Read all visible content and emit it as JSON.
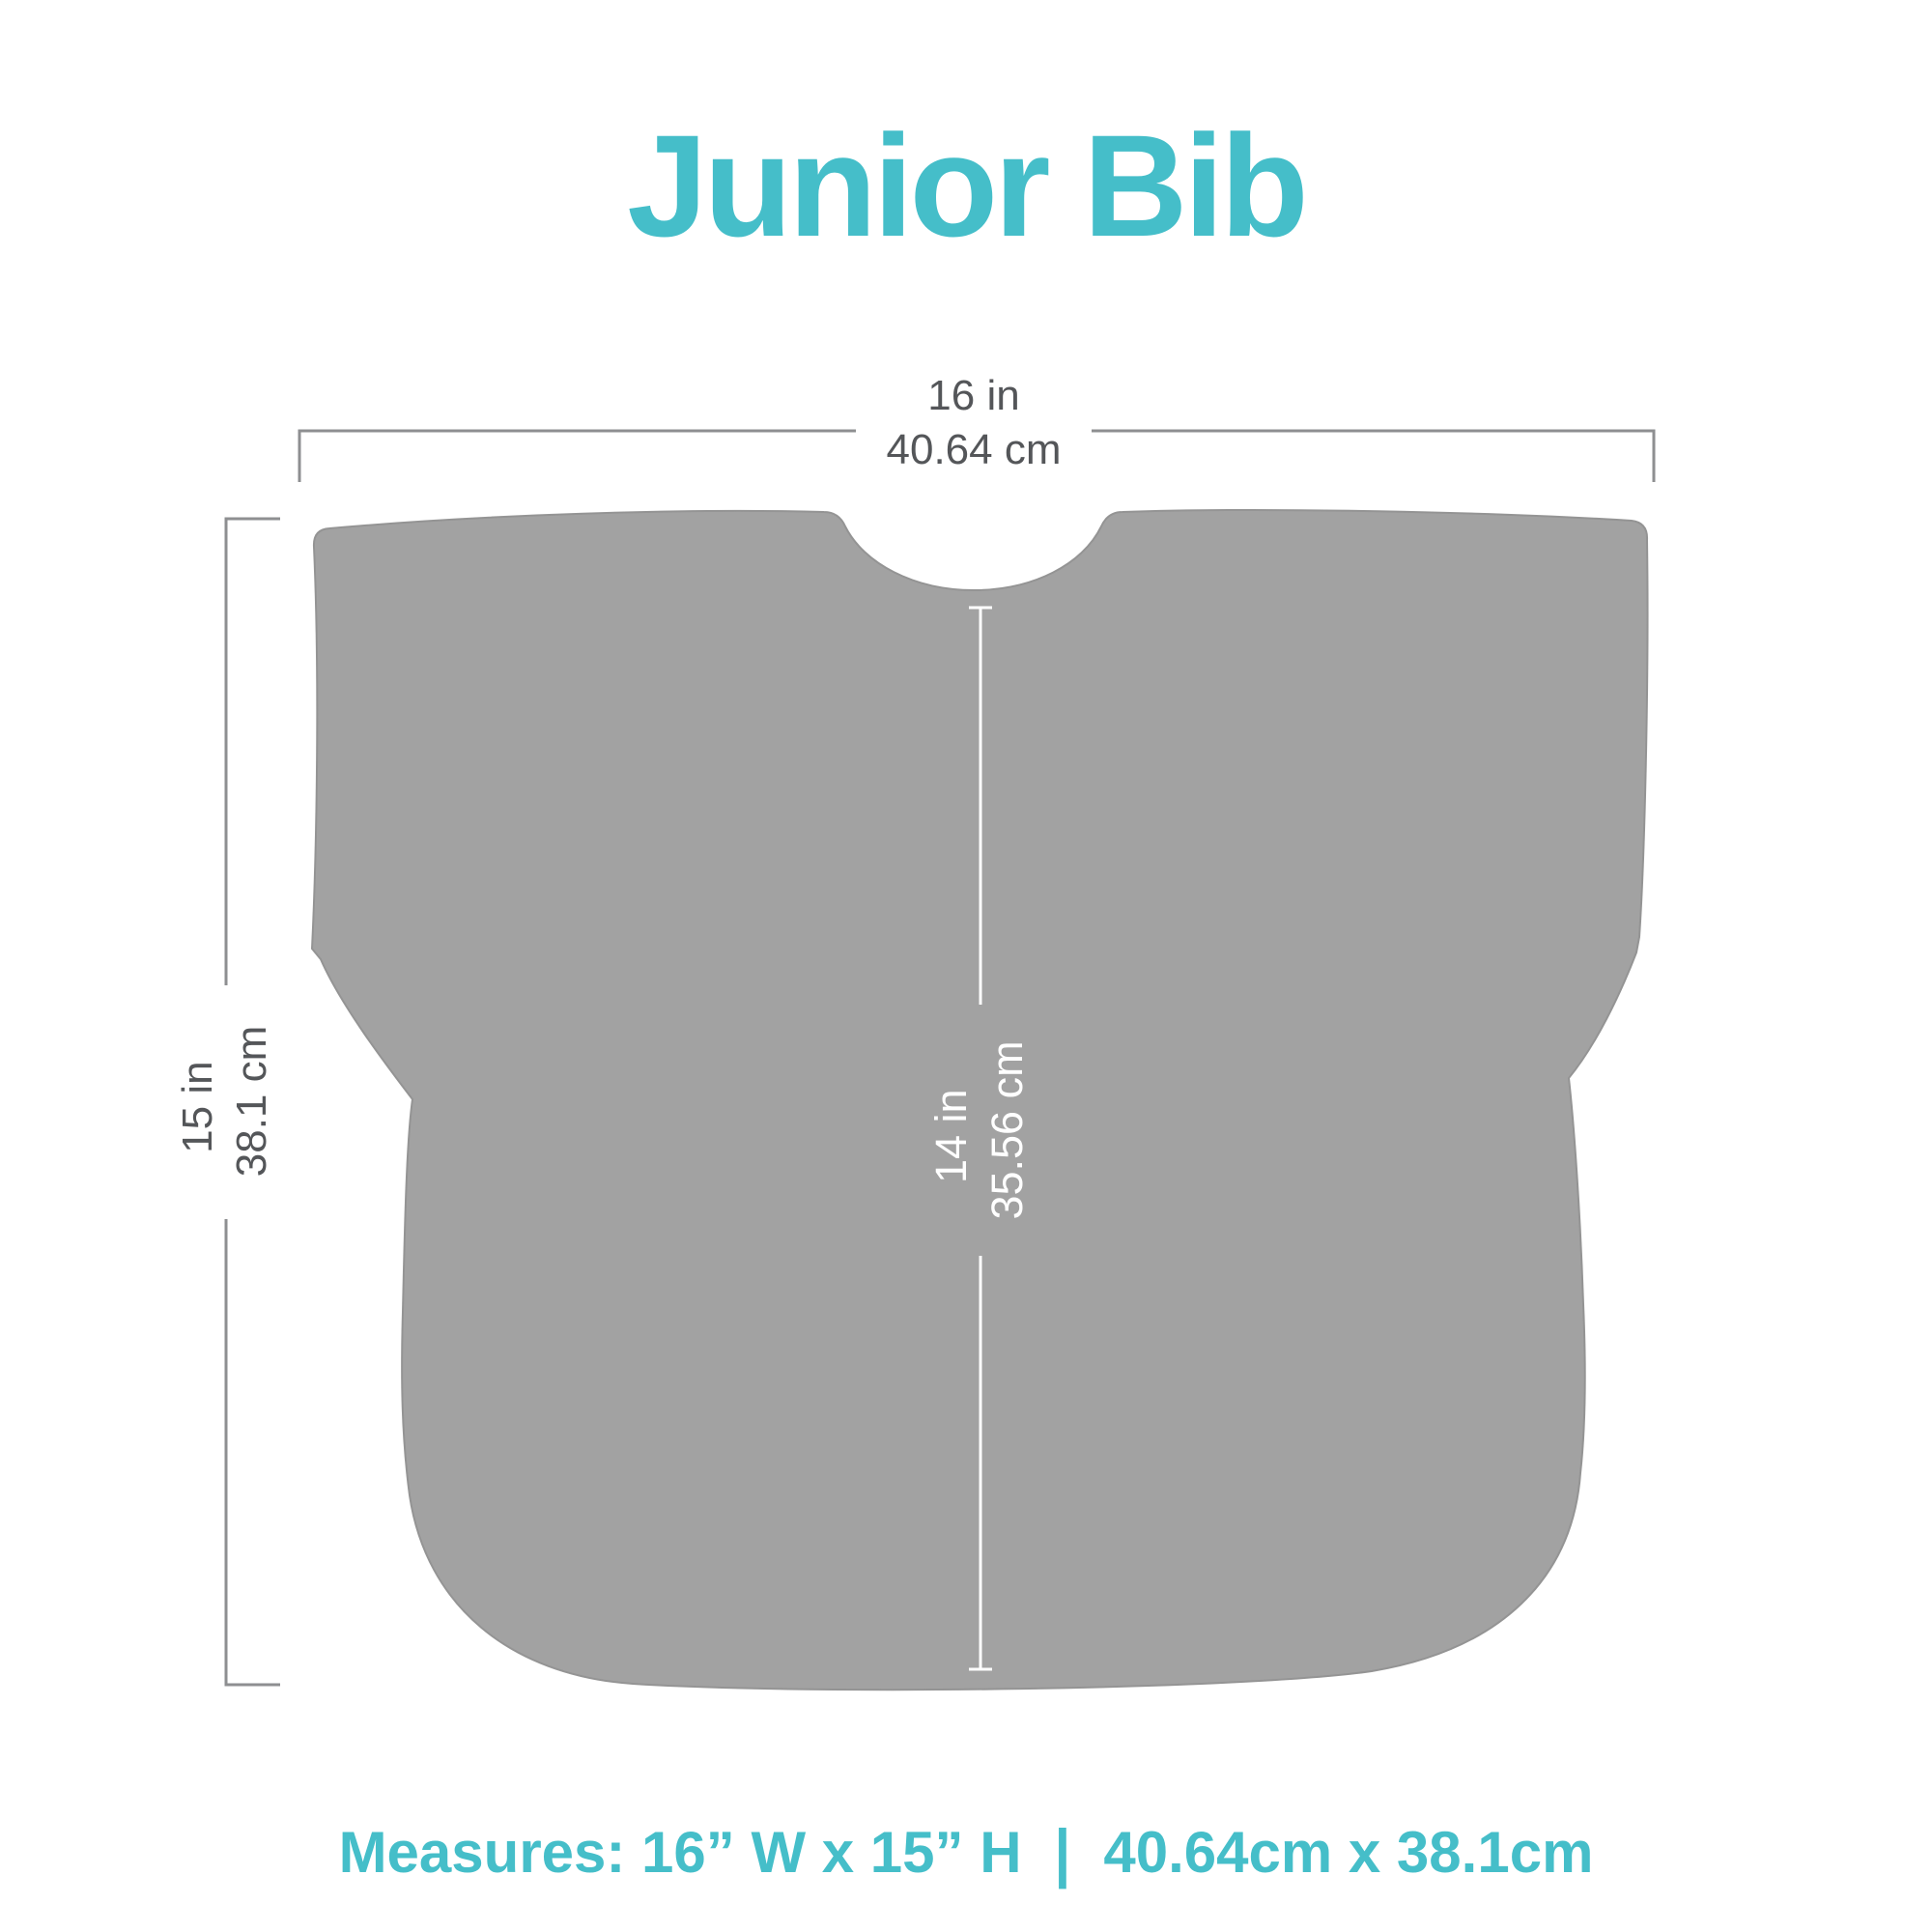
{
  "title": "Junior Bib",
  "colors": {
    "accent_teal": "#45bec9",
    "bib_fill": "#a2a2a2",
    "bib_outline": "#949494",
    "dimension_line_gray": "#8e8f91",
    "dimension_text_gray": "#545659",
    "inner_dimension_text": "#ffffff",
    "background": "#ffffff"
  },
  "dimensions": {
    "width": {
      "inches": "16 in",
      "cm": "40.64 cm"
    },
    "height": {
      "inches": "15 in",
      "cm": "38.1 cm"
    },
    "inner_height": {
      "inches": "14 in",
      "cm": "35.56 cm"
    }
  },
  "caption": {
    "imperial": "Measures: 16” W x 15” H",
    "separator": "|",
    "metric": "40.64cm x 38.1cm"
  }
}
